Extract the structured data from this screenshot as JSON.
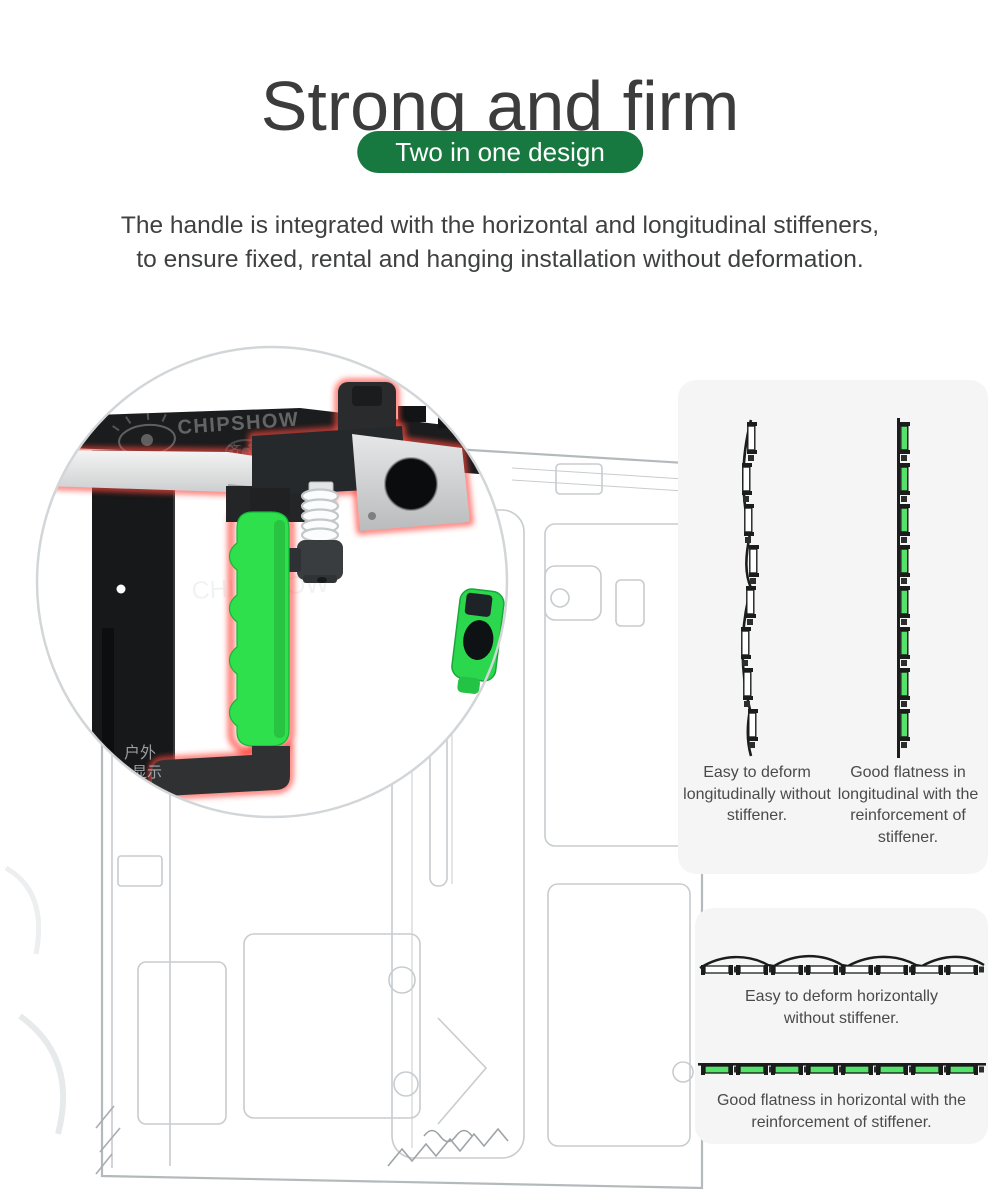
{
  "title": "Strong and firm",
  "badge": {
    "label": "Two in one design",
    "color": "#17793F"
  },
  "description": {
    "line1": "The handle is integrated with the horizontal and longitudinal stiffeners,",
    "line2": "to ensure fixed, rental and hanging installation without deformation."
  },
  "magnifier": {
    "brand": "CHIPSHOW",
    "brand_cn": "齐普光电",
    "brand2": "CHIPSHOW",
    "brand2_cn": "齐普光电",
    "corner_primary": "户外",
    "corner_secondary": "LED显示",
    "side_primary": "户外",
    "side_secondary": "显示",
    "ghost_brand": "CHIPSHOW",
    "ghost_cn": "光电"
  },
  "sketch": {
    "watermark": "CHIPSHOW"
  },
  "longitudinal": {
    "caption_without": "Easy to deform longitudinally without stiffener.",
    "caption_with": "Good flatness in longitudinal with the reinforcement of stiffener."
  },
  "horizontal": {
    "caption_without": "Easy to deform horizontally without stiffener.",
    "caption_with": "Good flatness in horizontal with the reinforcement of stiffener."
  },
  "colors": {
    "badge_green": "#17793F",
    "handle_green": "#2EE04B",
    "stiffener_green": "#55E26B",
    "glow_red": "#FF4840",
    "title_gray": "#3C3C3C",
    "caption_gray": "#4A4A4A",
    "panel_bg": "#F5F5F6"
  }
}
